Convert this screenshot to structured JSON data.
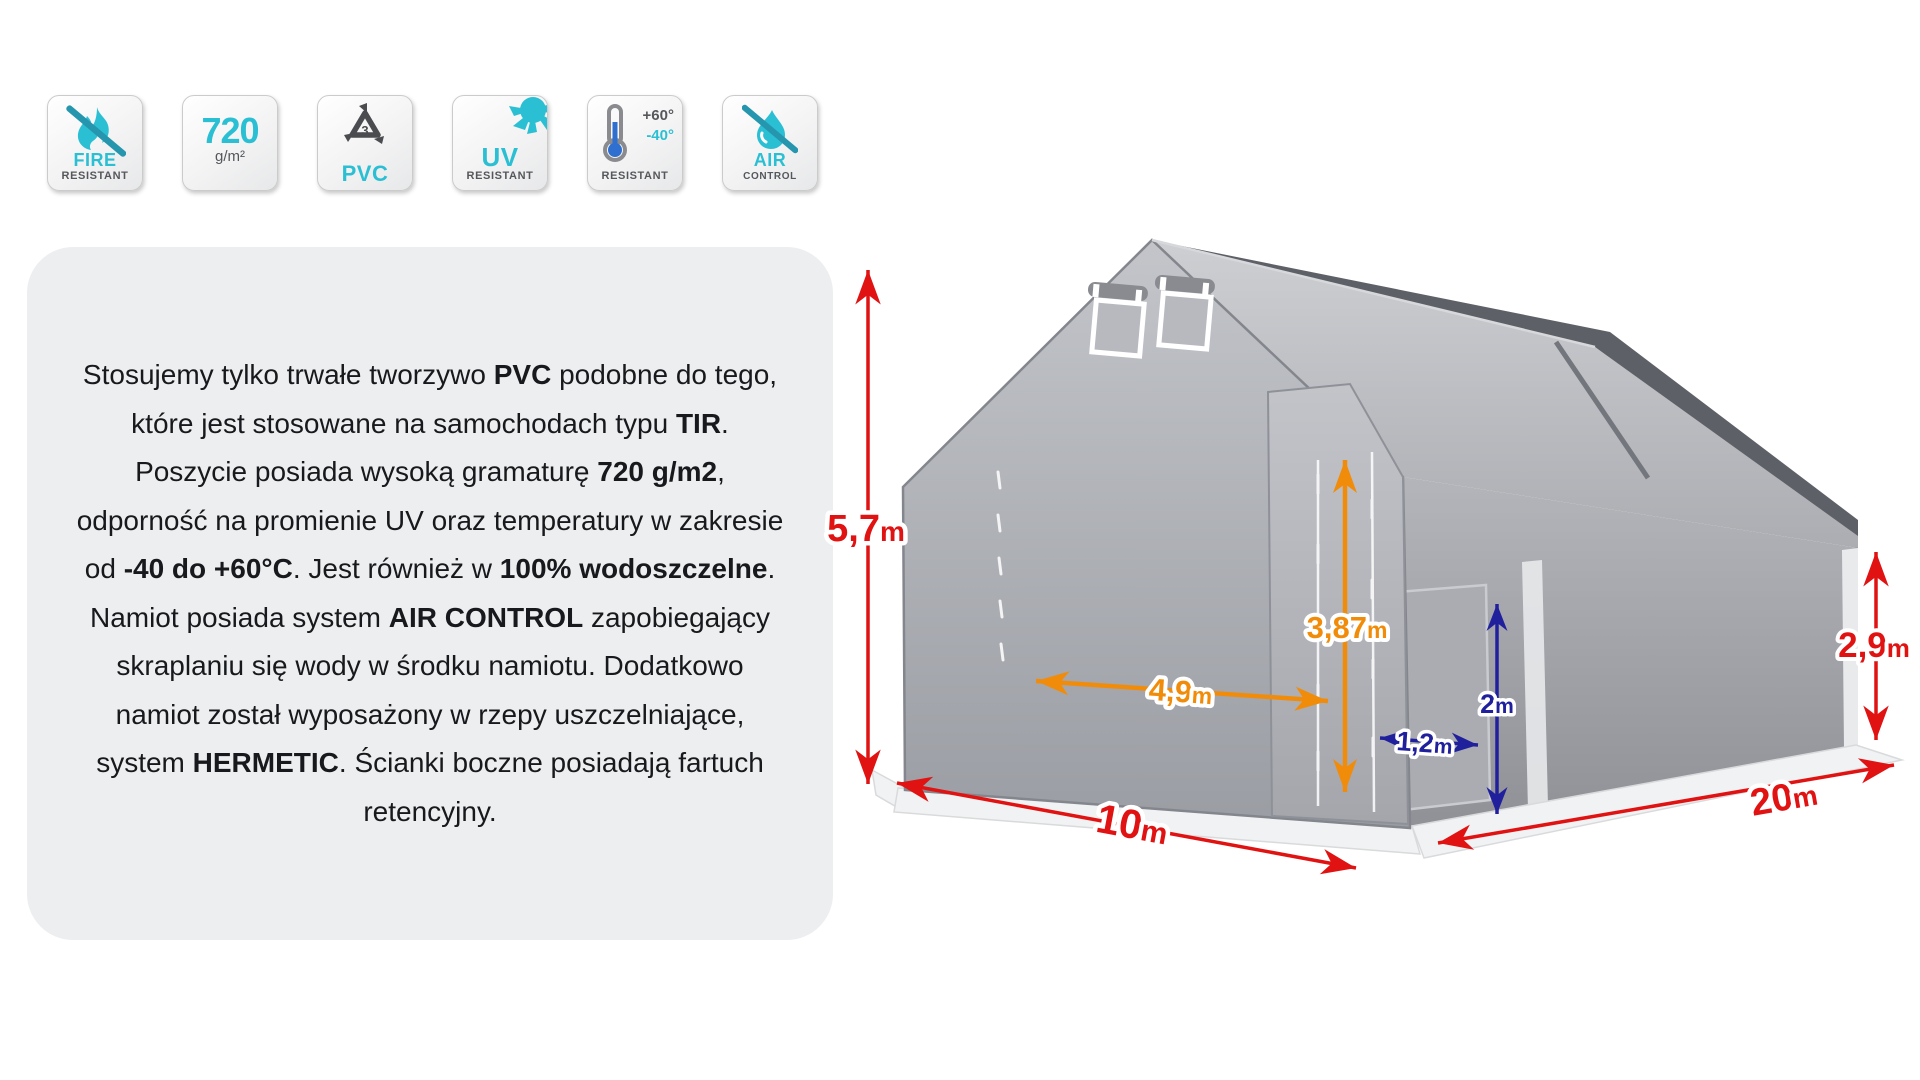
{
  "badges": {
    "fire": {
      "title": "FIRE",
      "subtitle": "RESISTANT"
    },
    "grammage": {
      "value": "720",
      "unit": "g/m²"
    },
    "pvc": {
      "code": "3",
      "label": "PVC"
    },
    "uv": {
      "title": "UV",
      "subtitle": "RESISTANT"
    },
    "temperature": {
      "max": "+60°",
      "min": "-40°",
      "subtitle": "RESISTANT"
    },
    "air": {
      "title": "AIR",
      "subtitle": "CONTROL"
    }
  },
  "description": {
    "segments": [
      {
        "text": "Stosujemy tylko trwałe tworzywo ",
        "bold": false
      },
      {
        "text": "PVC",
        "bold": true
      },
      {
        "text": " podobne do tego, które jest stosowane na samochodach typu ",
        "bold": false
      },
      {
        "text": "TIR",
        "bold": true
      },
      {
        "text": ". Poszycie posiada wysoką gramaturę ",
        "bold": false
      },
      {
        "text": "720 g/m2",
        "bold": true
      },
      {
        "text": ", odporność na promienie UV oraz temperatury w zakresie od ",
        "bold": false
      },
      {
        "text": "-40 do +60°C",
        "bold": true
      },
      {
        "text": ". Jest również w ",
        "bold": false
      },
      {
        "text": "100% wodoszczelne",
        "bold": true
      },
      {
        "text": ". Namiot posiada system ",
        "bold": false
      },
      {
        "text": "AIR CONTROL",
        "bold": true
      },
      {
        "text": " zapobiegający skraplaniu się wody w środku namiotu. Dodatkowo namiot został wyposażony w rzepy uszczelniające, system ",
        "bold": false
      },
      {
        "text": "HERMETIC",
        "bold": true
      },
      {
        "text": ". Ścianki boczne posiadają fartuch retencyjny.",
        "bold": false
      }
    ]
  },
  "diagram": {
    "dimensions": {
      "front_height": {
        "value": "5,7",
        "unit": "m"
      },
      "gate_height": {
        "value": "3,87",
        "unit": "m"
      },
      "gate_width": {
        "value": "4,9",
        "unit": "m"
      },
      "side_door_height": {
        "value": "2",
        "unit": "m"
      },
      "side_door_width": {
        "value": "1,2",
        "unit": "m"
      },
      "side_wall_height": {
        "value": "2,9",
        "unit": "m"
      },
      "front_width": {
        "value": "10",
        "unit": "m"
      },
      "length": {
        "value": "20",
        "unit": "m"
      }
    },
    "colors": {
      "red": "#e11212",
      "orange": "#f18c0a",
      "navy": "#20209d"
    }
  },
  "theme": {
    "accent_cyan": "#2bbfd3",
    "icon_gray": "#55575b",
    "panel_bg": "#edeef0"
  }
}
